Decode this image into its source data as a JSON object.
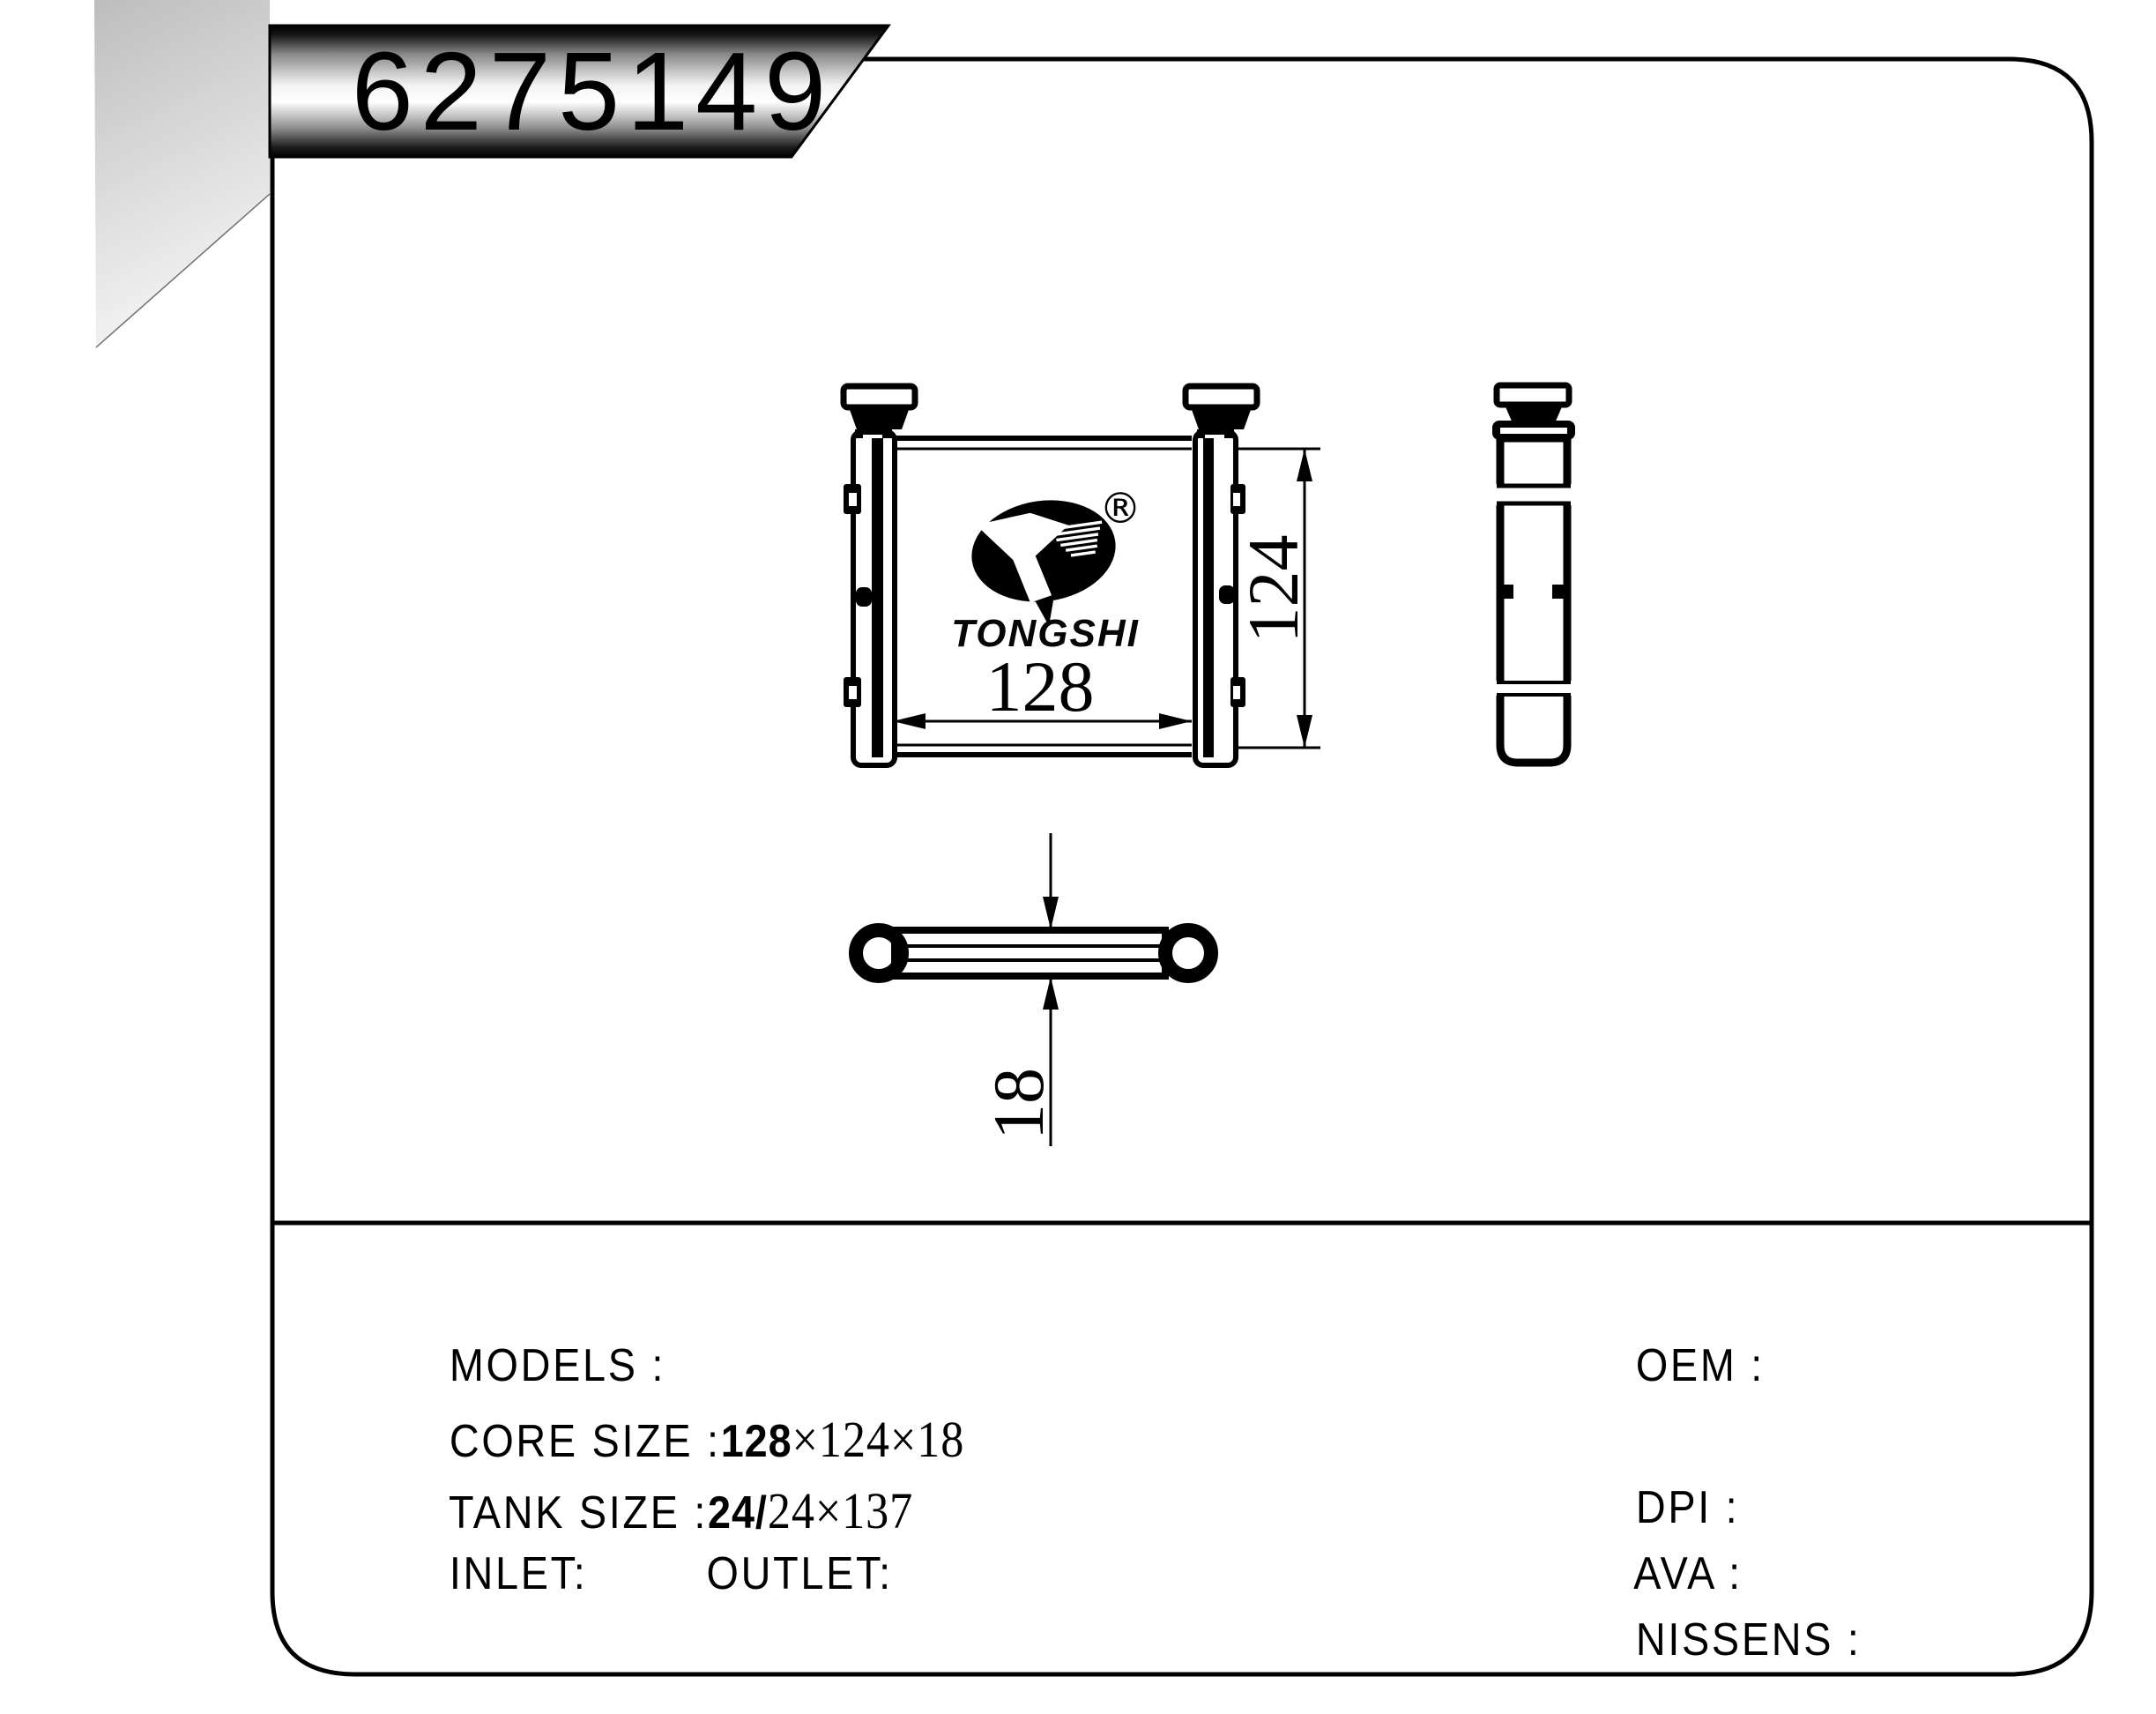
{
  "banner": {
    "part_number": "6275149"
  },
  "logo": {
    "brand": "TONGSHI",
    "registered_mark": "®"
  },
  "dimensions": {
    "core_width": "128",
    "core_height": "124",
    "core_depth": "18"
  },
  "specs": {
    "models_label": "MODELS :",
    "core_label": "CORE SIZE :",
    "core_value_bold": "128",
    "core_value_serif": "×124×18",
    "tank_label": "TANK SIZE :",
    "tank_value_bold": "24/",
    "tank_value_serif": "24×137",
    "inlet_label": "INLET:",
    "outlet_label": "OUTLET:",
    "oem_label": "OEM :",
    "dpi_label": "DPI :",
    "ava_label": "AVA :",
    "nissens_label": "NISSENS :"
  },
  "colors": {
    "line": "#000000",
    "corner_gray_top": "#bdbdbd",
    "corner_gray_bottom": "#f4f4f4",
    "banner_dark": "#000000",
    "banner_light": "#ffffff"
  }
}
